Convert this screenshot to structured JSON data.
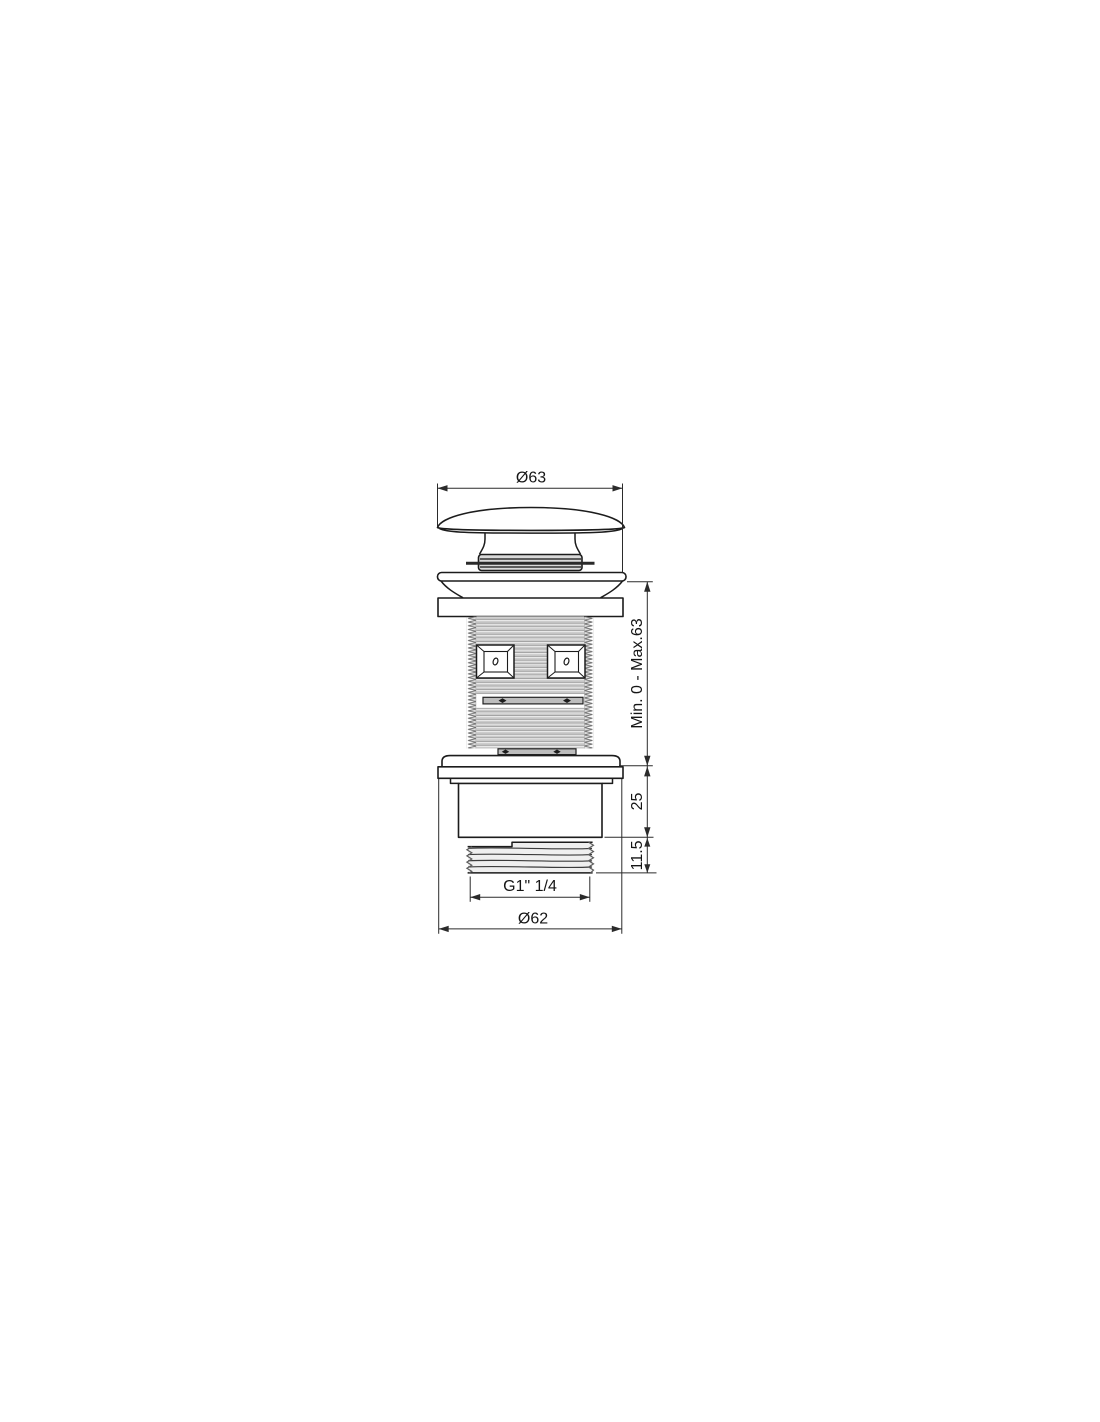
{
  "drawing": {
    "dimensions": {
      "cap_diameter": "Ø63",
      "adjust_range": "Min. 0 - Max.63",
      "body_height": "25",
      "outlet_thread_height": "11.5",
      "outlet_thread_size": "G1\" 1/4",
      "flange_diameter": "Ø62"
    },
    "colors": {
      "line": "#1c1c1c",
      "dimension_line": "#2b2b2b",
      "thread_light": "#cbcbcb",
      "thread_dark": "#8a8a8a",
      "seal_fill": "#bdbdbd",
      "background": "#ffffff"
    }
  }
}
